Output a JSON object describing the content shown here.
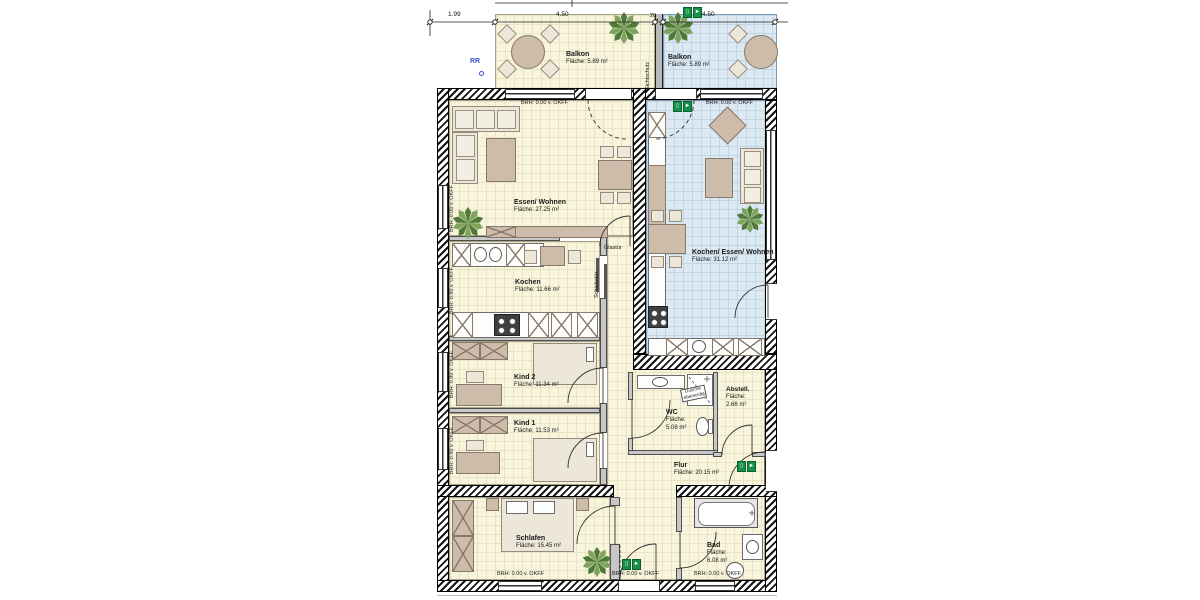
{
  "dims": {
    "d_left": "1.99",
    "d_balcony_left": "4.50",
    "d_gap": "20",
    "d_balcony_right": "4.50"
  },
  "balconies": {
    "left": {
      "name": "Balkon",
      "area": "Fläche: 5.89 m²"
    },
    "right": {
      "name": "Balkon",
      "area": "Fläche: 5.89 m²"
    },
    "divider": "Sichtschutz"
  },
  "markers": {
    "rr": "RR"
  },
  "rooms": {
    "living_left": {
      "name": "Essen/ Wohnen",
      "area": "Fläche: 27.25 m²"
    },
    "kitchen_left": {
      "name": "Kochen",
      "area": "Fläche: 11.66 m²"
    },
    "living_right": {
      "name": "Kochen/ Essen/ Wohnen",
      "area": "Fläche: 31.12 m²"
    },
    "kid2": {
      "name": "Kind 2",
      "area": "Fläche: 11.34 m²"
    },
    "kid1": {
      "name": "Kind 1",
      "area": "Fläche: 11.53 m²"
    },
    "wc": {
      "name": "WC",
      "area_label": "Fläche:",
      "area": "5.08 m²"
    },
    "shower": {
      "line1": "Dusche",
      "line2": "ebenerdig"
    },
    "storage": {
      "name": "Abstell.",
      "area_label": "Fläche:",
      "area": "2.66 m²"
    },
    "hall": {
      "name": "Flur",
      "area": "Fläche: 20.15 m²"
    },
    "bedroom": {
      "name": "Schlafen",
      "area": "Fläche: 15.45 m²"
    },
    "bath": {
      "name": "Bad",
      "area_label": "Fläche:",
      "area": "6.08 m²"
    }
  },
  "doors": {
    "glass": "Glastür",
    "sliding": "Schiebetür"
  },
  "sills": {
    "s000": "BRH: 0.00 v. OKFF",
    "s090": "BRH: 0.90 v. OKFF"
  },
  "icons": {
    "exit_arrow": "►",
    "exit_door": "▯"
  },
  "colors": {
    "room_yellow": "#f8f5dc",
    "room_blue": "#dce8f2",
    "exit_green": "#17914a",
    "marker_blue": "#3b4fd0"
  }
}
